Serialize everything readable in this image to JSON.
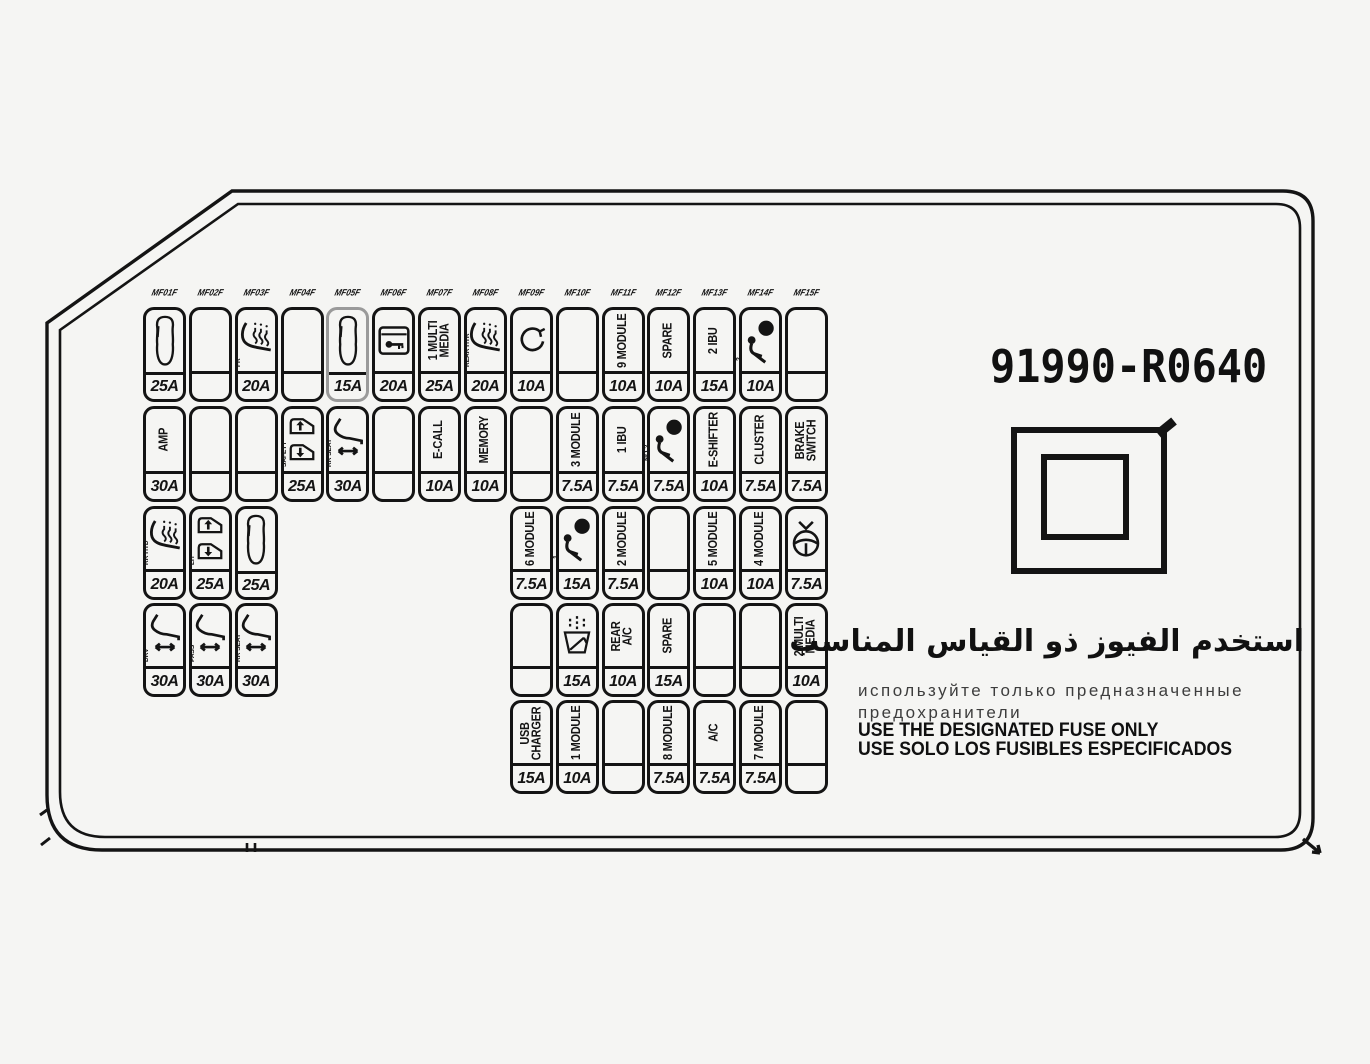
{
  "part_number": "91990-R0640",
  "notices": {
    "arabic": "استخدم الفيوز ذو القياس المناسب",
    "russian": "используйте только предназначенные предохранители",
    "english": "USE THE DESIGNATED FUSE ONLY",
    "spanish": "USE SOLO LOS FUSIBLES ESPECIFICADOS"
  },
  "colors": {
    "line": "#141414",
    "background": "#f5f5f3",
    "muted_cell": "#9a9a9a"
  },
  "fuse_panel": {
    "column_codes": [
      "MF01F",
      "MF02F",
      "MF03F",
      "MF04F",
      "MF05F",
      "MF06F",
      "MF07F",
      "MF08F",
      "MF09F",
      "MF10F",
      "MF11F",
      "MF12F",
      "MF13F",
      "MF14F",
      "MF15F"
    ],
    "rows": [
      {
        "cells": [
          {
            "col": 0,
            "icon": "car",
            "amp": "25A"
          },
          {
            "col": 1
          },
          {
            "col": 2,
            "icon": "seat-heat",
            "side": "FR",
            "amp": "20A"
          },
          {
            "col": 3
          },
          {
            "col": 4,
            "icon": "car",
            "amp": "15A",
            "muted": true
          },
          {
            "col": 5,
            "icon": "door-key",
            "amp": "20A"
          },
          {
            "col": 6,
            "label": "MULTI MEDIA",
            "prefix": "1",
            "amp": "25A"
          },
          {
            "col": 7,
            "icon": "seat-heat",
            "side": "REAR HTR",
            "amp": "20A"
          },
          {
            "col": 8,
            "icon": "rotate",
            "amp": "10A"
          },
          {
            "col": 9
          },
          {
            "col": 10,
            "label": "MODULE",
            "prefix": "9",
            "amp": "10A"
          },
          {
            "col": 11,
            "label": "SPARE",
            "amp": "10A"
          },
          {
            "col": 12,
            "label": "IBU",
            "prefix": "2",
            "amp": "15A"
          },
          {
            "col": 13,
            "icon": "airbag",
            "prefix": "2",
            "amp": "10A"
          },
          {
            "col": 14
          }
        ]
      },
      {
        "cells": [
          {
            "col": 0,
            "label": "AMP",
            "amp": "30A"
          },
          {
            "col": 1
          },
          {
            "col": 2
          },
          {
            "col": 3,
            "icon": "window",
            "side": "SAFETY",
            "amp": "25A"
          },
          {
            "col": 4,
            "icon": "seat-power",
            "side": "RR SEAT",
            "amp": "30A"
          },
          {
            "col": 5
          },
          {
            "col": 6,
            "label": "E-CALL",
            "amp": "10A"
          },
          {
            "col": 7,
            "label": "MEMORY",
            "amp": "10A"
          },
          {
            "col": 8
          },
          {
            "col": 9,
            "label": "MODULE",
            "prefix": "3",
            "amp": "7.5A"
          },
          {
            "col": 10,
            "label": "IBU",
            "prefix": "1",
            "amp": "7.5A"
          },
          {
            "col": 11,
            "icon": "airbag",
            "prefix": "NO.2",
            "amp": "7.5A"
          },
          {
            "col": 12,
            "label": "E-SHIFTER",
            "amp": "10A"
          },
          {
            "col": 13,
            "label": "CLUSTER",
            "amp": "7.5A"
          },
          {
            "col": 14,
            "label": "BRAKE SWITCH",
            "amp": "7.5A"
          }
        ]
      },
      {
        "cells": [
          {
            "col": 0,
            "icon": "seat-heat",
            "side": "RR HTD",
            "amp": "20A"
          },
          {
            "col": 1,
            "icon": "window",
            "side": "LH",
            "amp": "25A"
          },
          {
            "col": 2,
            "icon": "car",
            "amp": "25A"
          },
          {
            "col": 8,
            "label": "MODULE",
            "prefix": "6",
            "amp": "7.5A"
          },
          {
            "col": 9,
            "icon": "airbag",
            "prefix": "1",
            "amp": "15A"
          },
          {
            "col": 10,
            "label": "MODULE",
            "prefix": "2",
            "amp": "7.5A"
          },
          {
            "col": 11
          },
          {
            "col": 12,
            "label": "MODULE",
            "prefix": "5",
            "amp": "10A"
          },
          {
            "col": 13,
            "label": "MODULE",
            "prefix": "4",
            "amp": "10A"
          },
          {
            "col": 14,
            "icon": "steering",
            "amp": "7.5A"
          }
        ]
      },
      {
        "cells": [
          {
            "col": 0,
            "icon": "seat-power",
            "side": "DRV",
            "amp": "30A"
          },
          {
            "col": 1,
            "icon": "seat-power",
            "side": "PASS",
            "amp": "30A"
          },
          {
            "col": 2,
            "icon": "seat-power",
            "side": "RR SEAT",
            "amp": "30A"
          },
          {
            "col": 8
          },
          {
            "col": 9,
            "icon": "washer",
            "amp": "15A"
          },
          {
            "col": 10,
            "label": "REAR A/C",
            "amp": "10A"
          },
          {
            "col": 11,
            "label": "SPARE",
            "amp": "15A"
          },
          {
            "col": 12
          },
          {
            "col": 13
          },
          {
            "col": 14,
            "label": "MULTI MEDIA",
            "prefix": "2",
            "amp": "10A"
          }
        ]
      },
      {
        "cells": [
          {
            "col": 8,
            "label": "USB CHARGER",
            "amp": "15A"
          },
          {
            "col": 9,
            "label": "MODULE",
            "prefix": "1",
            "amp": "10A"
          },
          {
            "col": 10
          },
          {
            "col": 11,
            "label": "MODULE",
            "prefix": "8",
            "amp": "7.5A"
          },
          {
            "col": 12,
            "label": "A/C",
            "amp": "7.5A"
          },
          {
            "col": 13,
            "label": "MODULE",
            "prefix": "7",
            "amp": "7.5A"
          },
          {
            "col": 14
          }
        ]
      }
    ]
  }
}
